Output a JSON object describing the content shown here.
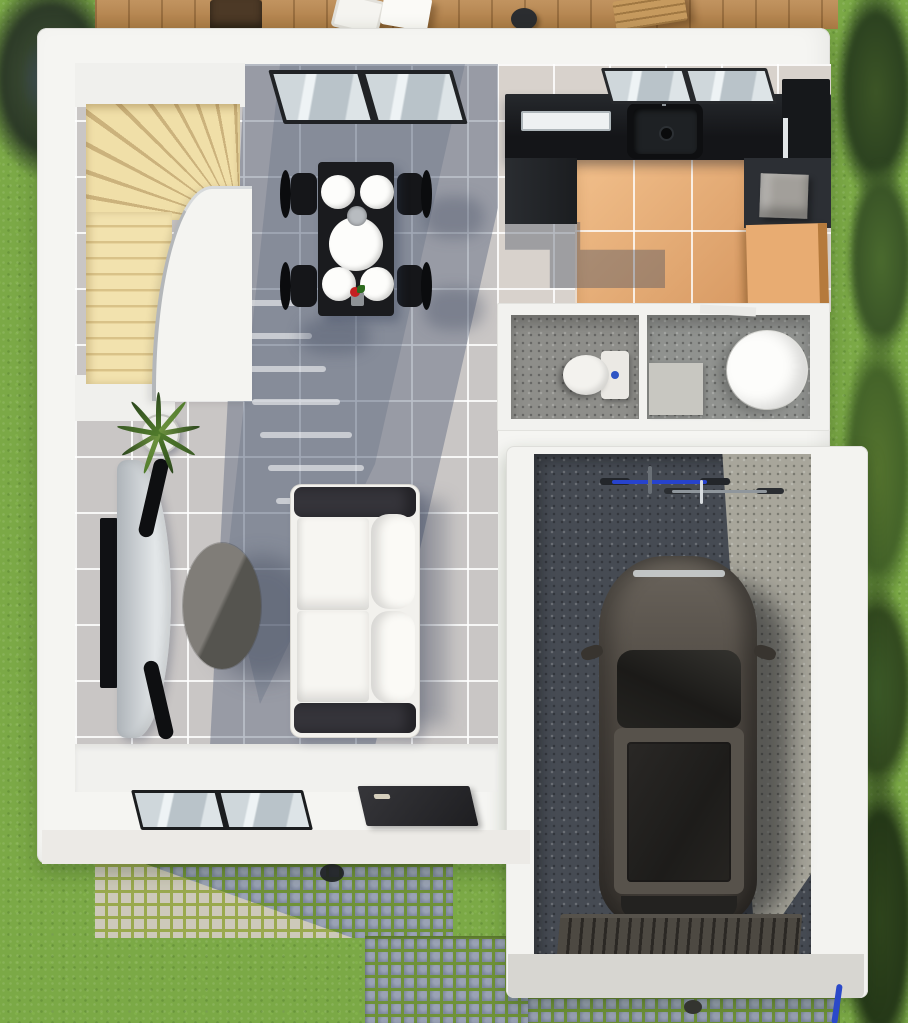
{
  "meta": {
    "title": "House ground floor – 3D top-down architectural render",
    "type": "architectural-3d-floorplan",
    "view": "top-down",
    "width_px": 908,
    "height_px": 1023
  },
  "palette": {
    "lawn_green": "#7BA946",
    "deck_wood": "#B9854A",
    "stair_wood": "#EBD7A0",
    "wall_white": "#F5F5F2",
    "tile_gray": "#C9C6C5",
    "shadow_blue": "#4A5670",
    "kitchen_floor_orange": "#E8AC72",
    "counter_black": "#17191C",
    "concrete_dark": "#464B53",
    "concrete_light": "#A8A69B",
    "cobble_blue_gray": "#8A93A8",
    "cobble_light": "#CDC9BA",
    "car_body": "#4E4943",
    "sofa_white": "#F4F3EF",
    "bike_blue": "#2743CC",
    "toilet_button_blue": "#2E55C4"
  },
  "exterior": {
    "lawn": "grass lawn surrounding the house",
    "deck": {
      "label": "wooden terrace deck along top edge",
      "items": [
        "dark planter box",
        "white lounge chairs",
        "black round stool",
        "wooden bench"
      ]
    },
    "paths": {
      "cobblestone": "cobblestone path and driveway with grassy joints, sunlit light patch at left",
      "apron": "light concrete apron at garage door",
      "details": [
        "round stoop light on cobbles",
        "floor drain in driveway",
        "blue garden hose at right"
      ]
    },
    "vegetation": [
      "dark bush top-left corner",
      "row of trees along right edge"
    ]
  },
  "rooms": [
    {
      "name": "living-dining",
      "floor": "light gray ceramic tiles with large diagonal daylight shadow",
      "features": [
        "curved light-wood winder staircase",
        "patio sliding glass door in top wall",
        "railing light dashes on floor"
      ],
      "furniture": [
        "black rectangular dining table",
        "four black dining chairs",
        "four white plates and one large white serving plate",
        "small gray bowl and red mini plant centerpiece",
        "white two-seat sofa with dark charcoal armrests and white back cushions",
        "dark oval coffee table",
        "wall-mounted TV on left wall",
        "curved gray media console with black end caps",
        "green potted plant in white pot"
      ]
    },
    {
      "name": "kitchen",
      "floor": "terracotta-orange tile inset within gray tiles",
      "furniture": [
        "black L-shaped countertop run along top wall",
        "dark undermount sink with drain and faucet",
        "stainless hood/handle strip",
        "dark base cabinet block",
        "tall black cabinet (fridge) at right",
        "gray appliance cube on right counter",
        "orange wooden base cabinet",
        "window above the counter"
      ]
    },
    {
      "name": "wc",
      "floor": "gray speckled tile",
      "furniture": [
        "white toilet with cistern and blue flush button"
      ]
    },
    {
      "name": "shower-room",
      "floor": "gray speckled tile",
      "furniture": [
        "round white soaking tub",
        "light gray shower mat",
        "white door leaf at top"
      ]
    },
    {
      "name": "garage",
      "floor": "dark concrete with sunlit light strip on the right",
      "furniture": [
        "dark SUV parked (top view) with sunroof, rear light strip and side mirrors",
        "two bicycles against top wall (blue frame and silver frame)",
        "slatted dark garage door at bottom"
      ]
    },
    {
      "name": "entry",
      "features": [
        "dark front door with light handle",
        "low window in bottom wall",
        "white entry floor strip"
      ]
    }
  ]
}
